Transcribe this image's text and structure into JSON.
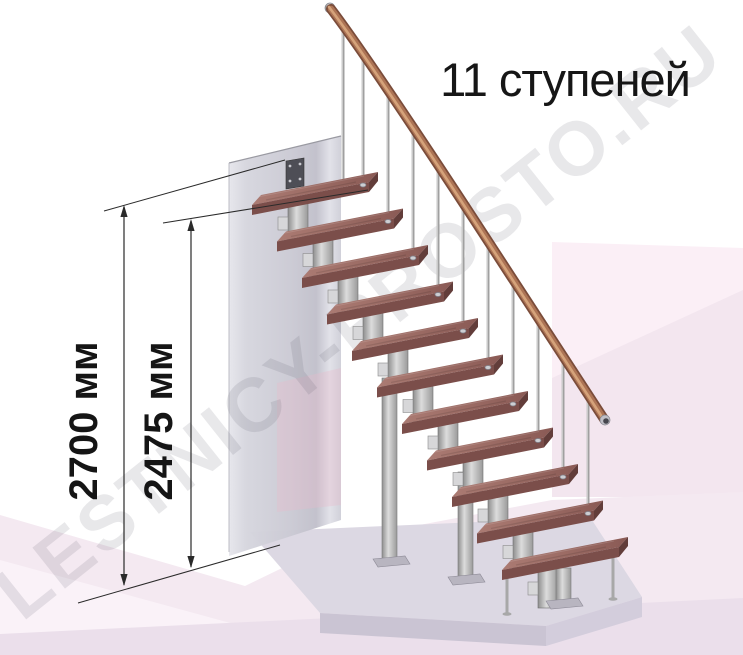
{
  "scene": {
    "title": "11 ступеней",
    "watermark": "LESTNICY-PROSTO.RU"
  },
  "dimensions": [
    {
      "label": "2700 мм"
    },
    {
      "label": "2475 мм"
    }
  ],
  "stairs": {
    "step_count": 11
  },
  "colors": {
    "tread_top": "#9a6a63",
    "tread_top_light": "#ab7b73",
    "tread_top_dark": "#8a5a55",
    "tread_front": "#7b4e4a",
    "tread_side": "#623d3a",
    "rail_dark": "#7a4c3a",
    "rail_mid": "#ad7455",
    "rail_highlight": "#d9a97f",
    "metal_light": "#dcdcdc",
    "metal_mid": "#a8a8a8",
    "metal_dark": "#8e8e8e",
    "flange": "#b8b5c0",
    "bracket_plate": "#4e4e56",
    "wall": "#cfcfd8",
    "wall_tint": "#e8b9cc",
    "floor": "#f4e9f1",
    "floor_light": "#faf2f8",
    "floor_strip": "#ebdfeb",
    "panel": "#fbeff6",
    "panel_facet": "#f3e6ef",
    "slab_top": "#dcd8e3",
    "slab_front": "#cac4d3",
    "slab_side": "#d3cddc",
    "dimension_line": "#2a2a2a",
    "text": "#161616"
  }
}
